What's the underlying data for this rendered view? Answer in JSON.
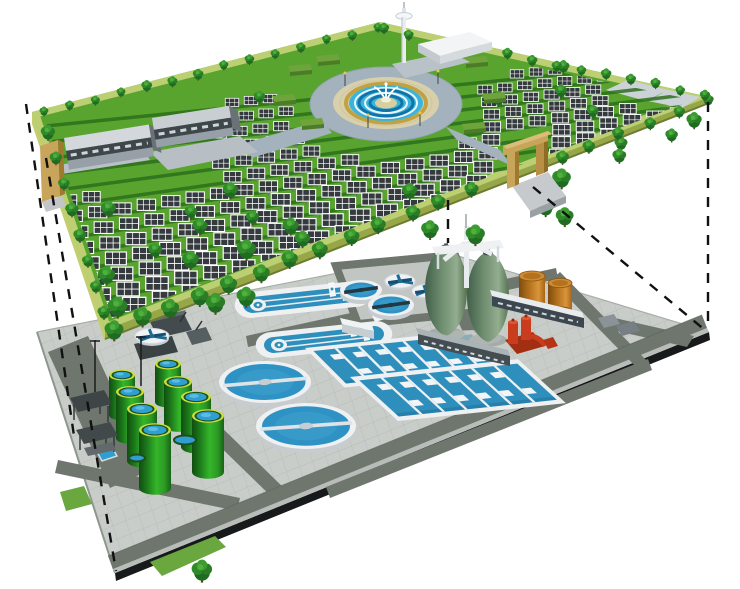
{
  "meta": {
    "title": "Cutaway illustration: ground-level solar park above an underground wastewater treatment plant",
    "style": "3D architectural rendering on white background",
    "visible_text": []
  },
  "upper_level": {
    "name": "solar park at ground level",
    "solar_panel_rows": 14,
    "office_buildings": 2,
    "entrance_gates": 2,
    "features": [
      "solar-panel-arrays",
      "tree-rows",
      "central-fountain-plaza",
      "circular-ring-road",
      "radial-paths",
      "hedge-planters",
      "observation-tower",
      "white-pavilion",
      "perimeter-border",
      "tan-gate-portals"
    ]
  },
  "lower_level": {
    "name": "underground wastewater treatment plant",
    "circular_clarifiers": 2,
    "oxidation_ditches": 2,
    "aeration_basins": 2,
    "aeration_lanes_per_basin": 7,
    "green_storage_tanks": 8,
    "egg_digesters": 2,
    "orange_tanks": 2,
    "small_round_tanks": 5,
    "features": [
      "paved-deck",
      "service-roads",
      "clarifier-bridges",
      "digester-gantry",
      "pump-unit-red",
      "service-buildings",
      "carport-sheds",
      "light-poles"
    ]
  },
  "projection": {
    "dashed_lines_count": 5
  },
  "colors": {
    "bg": "#ffffff",
    "grass": "#58a42e",
    "rowShadow": "#2c6e1b",
    "parkBorder": "#bccf72",
    "parkSideLeft": "#c3cf6f",
    "parkSideFront": "#97a748",
    "parkSideDark": "#6d7c33",
    "tree1": "#1e6b21",
    "tree2": "#2f8a28",
    "tree3": "#3c9c32",
    "trunk": "#5c4326",
    "panel": "#343a3e",
    "panelGrid": "#ffffff",
    "plazaRoad": "#a3b2bd",
    "plazaPaving": "#d8d0ab",
    "plazaGold": "#c2a143",
    "plazaBlue": "#3ab4dc",
    "plazaBlueDark": "#1273a8",
    "fountain": "#ffffff",
    "buildingRoof": "#d4d8dc",
    "buildingBand": "#3f474d",
    "buildingBase": "#97a0a8",
    "towerWhite": "#eef1f4",
    "pavilion": "#f2f4f6",
    "gateTan": "#c9a45b",
    "gateTanLight": "#d9bd78",
    "gateTanDark": "#9e7a2f",
    "pavement": "#c9cdc9",
    "pavementLine": "#b3b8b3",
    "roadDark": "#6e766e",
    "curb": "#b9bdb9",
    "platformSide": "#17191b",
    "rimWhite": "#eef0f2",
    "wallShade": "#c6ccd0",
    "waterBlue": "#2e93c4",
    "waterLight": "#49aad4",
    "laneBlue": "#2e8fbc",
    "barDark": "#223843",
    "spokeBlue": "#1d6a94",
    "tankGreenDark": "#145c12",
    "tankGreenMid": "#2f9c26",
    "tankGreenLight": "#43c431",
    "tankRim": "#cadf3d",
    "tankRingDark": "#1d4f1d",
    "tankTopBlue": "#2f9fd2",
    "digesterDark": "#42604a",
    "digesterMid": "#6f8d6f",
    "digesterLight": "#93ad8f",
    "orange": "#b5721e",
    "orangeDark": "#8a5410",
    "orangeTop": "#cd8c33",
    "red": "#c93d1e",
    "redDark": "#8f2a10",
    "redLight": "#e2562f",
    "shed": "#434b4e",
    "shedRoof": "#5f686b",
    "grayBlock": "#8b9398",
    "greenPatch": "#6aa73f",
    "dash": "#111111"
  }
}
